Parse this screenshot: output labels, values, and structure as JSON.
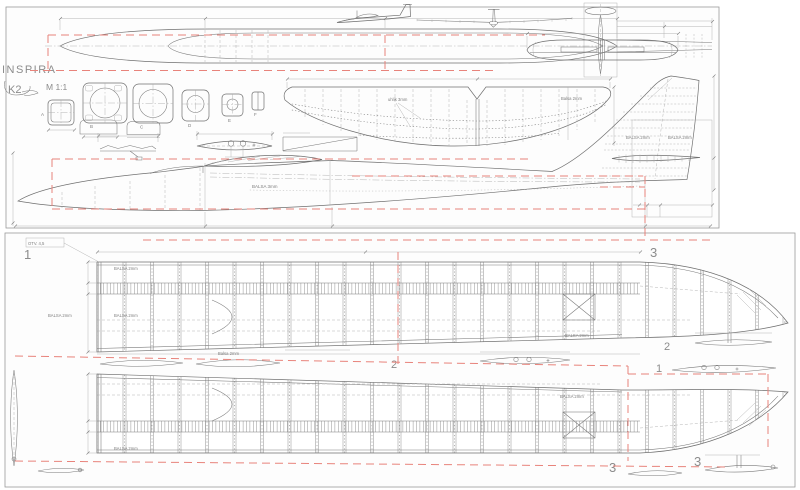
{
  "colors": {
    "ink": "#6f6f6f",
    "light": "#adadad",
    "red": "#e8837b",
    "label": "#8c8c8c",
    "sheet_border": "#999999"
  },
  "title_block": {
    "title": "INSPIRA",
    "logo": "K2",
    "scale": "M 1:1"
  },
  "formers": {
    "a": "A",
    "b": "B",
    "c": "C",
    "d": "D",
    "e": "E",
    "f": "F"
  },
  "notes": {
    "fuselage": "BALSA 3mm",
    "fin_left": "BALSA 2mm",
    "fin_right": "BALSA 2mm",
    "wing_spar": "uhlík 3mm",
    "wing_skin": "Balsa 2mm",
    "root_hole": "OTV. 4,5",
    "panel_note_1": "BALSA 2mm",
    "panel_note_2": "BALSA 2mm",
    "panel_note_3": "BALSA 2mm",
    "panel_note_4": "BALSA 2mm",
    "panel_bottom_note_1": "BALSA 2mm",
    "panel_bottom_note_2": "BALSA 2mm",
    "template_note": "Balsa 2mm"
  },
  "part_numbers": {
    "top_panel_root": "1",
    "top_panel_tip": "3",
    "mid_left": "2",
    "mid_right": "1",
    "gap_top_right": "2",
    "bottom_panel_a": "3",
    "bottom_panel_b": "3"
  }
}
